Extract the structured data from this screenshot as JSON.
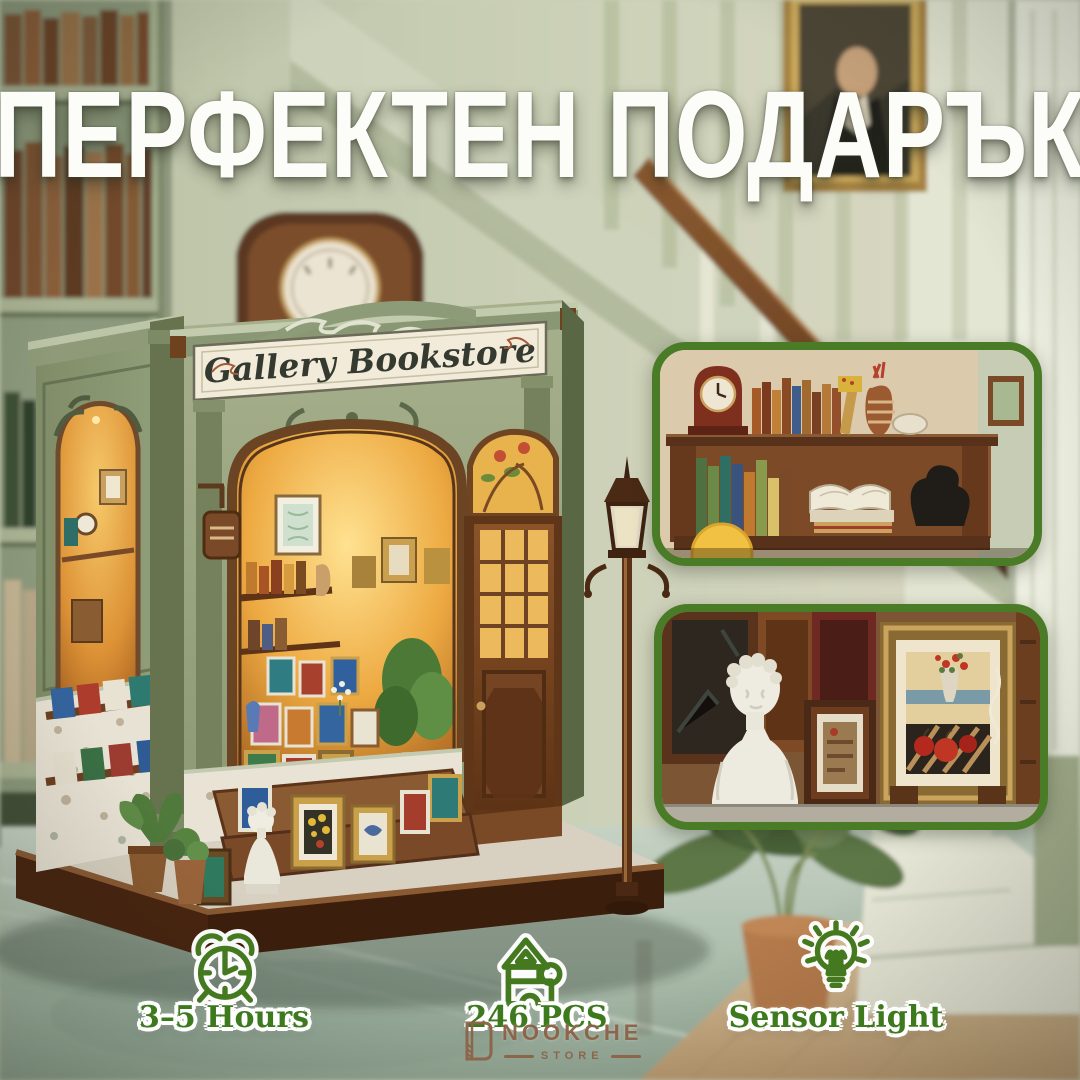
{
  "title": "ПЕРФЕКТЕН ПОДАРЪК",
  "product": {
    "sign_text": "Gallery Bookstore"
  },
  "features": [
    {
      "icon": "alarm-clock-icon",
      "label": "3–5 Hours"
    },
    {
      "icon": "house-pieces-icon",
      "label": "246 PCS"
    },
    {
      "icon": "sensor-bulb-icon",
      "label": "Sensor Light"
    }
  ],
  "logo": {
    "brand": "NOOKCHE",
    "tagline": "STORE"
  },
  "colors": {
    "feature_green": "#3e7a1f",
    "inset_border_green": "#4a7c27",
    "logo_brown": "#8c6248",
    "sign_cream": "#f2ebd9",
    "facade_sage": "#93a07c",
    "glow_amber": "#eaa83f"
  }
}
